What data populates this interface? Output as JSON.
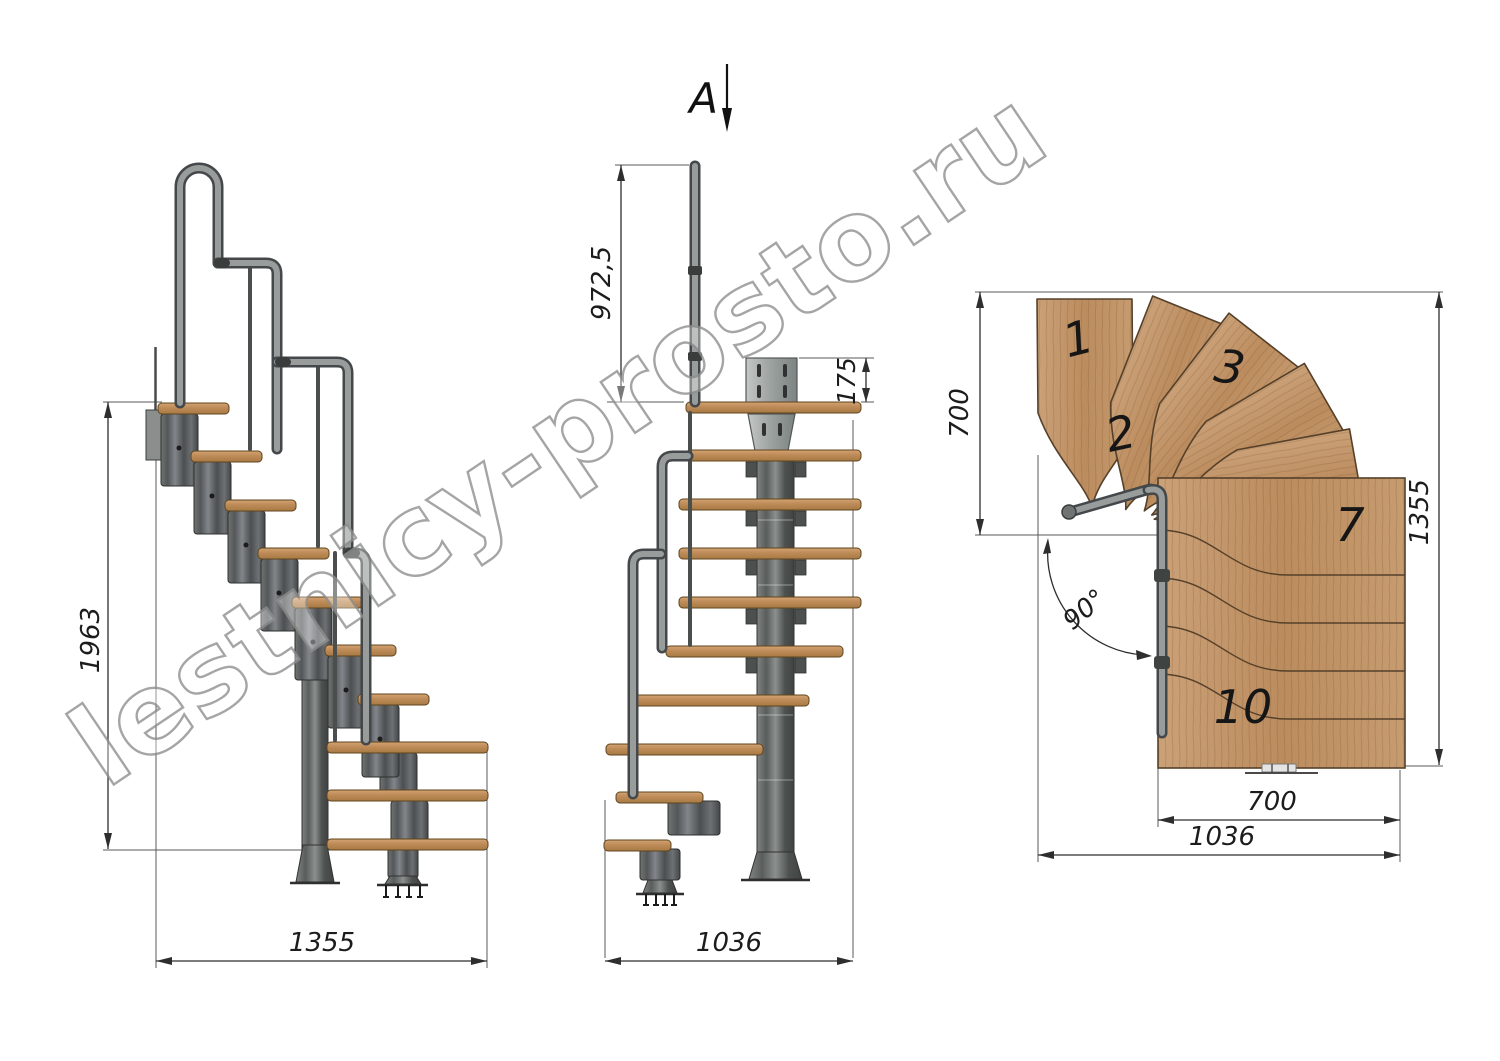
{
  "watermark": {
    "text": "lestnicy-prosto.ru"
  },
  "side_view": {
    "dim_height": "1963",
    "dim_width": "1355"
  },
  "front_view": {
    "section_label": "A",
    "dim_rail_height": "972,5",
    "dim_plate_height": "175",
    "dim_width": "1036"
  },
  "plan_view": {
    "dim_upper_depth": "700",
    "dim_total_height": "1355",
    "dim_lower_width": "700",
    "dim_total_width": "1036",
    "turn_angle": "90°",
    "tread_labels": {
      "t1": "1",
      "t2": "2",
      "t3": "3",
      "t7": "7",
      "t10": "10"
    }
  },
  "colors": {
    "wood": "#c49a6f",
    "metal": "#85898a",
    "metal_dark": "#45494b",
    "dimension_line": "#2e2e2e",
    "watermark_gray": "#909090"
  }
}
